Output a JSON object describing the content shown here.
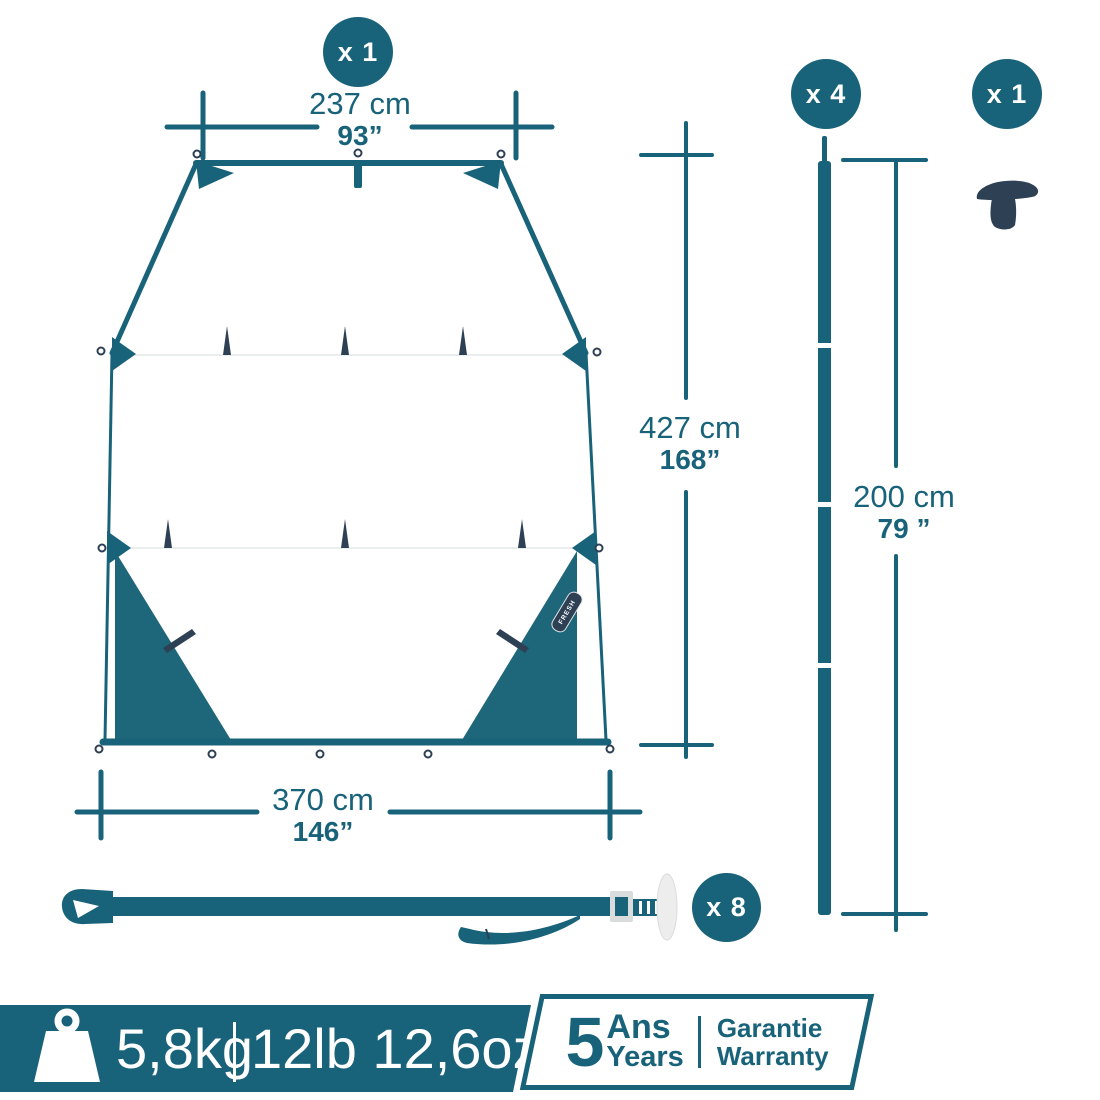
{
  "colors": {
    "teal": "#19637A",
    "teal-fill": "#1E6679",
    "navy": "#2E4054",
    "gray": "#EDEDED"
  },
  "counts": {
    "tarp": "x 1",
    "poles": "x 4",
    "cap": "x 1",
    "straps": "x 8"
  },
  "dimensions": {
    "top_width": {
      "metric": "237 cm",
      "imperial": "93”"
    },
    "length": {
      "metric": "427 cm",
      "imperial": "168”"
    },
    "bottom_width": {
      "metric": "370 cm",
      "imperial": "146”"
    },
    "pole_length": {
      "metric": "200 cm",
      "imperial": "79 ”"
    }
  },
  "tarp": {
    "tag": "FRESH",
    "brand": "QUECHUA",
    "size": "XL"
  },
  "footer": {
    "weight_metric": "5,8kg",
    "weight_imperial": "12lb 12,6oz",
    "warranty_years": "5",
    "warranty_fr": "Ans",
    "warranty_en": "Years",
    "warranty_label_fr": "Garantie",
    "warranty_label_en": "Warranty"
  },
  "icons": {
    "weight": "weight-icon",
    "pole": "pole-icon",
    "pole_cap": "pole-cap-icon",
    "strap": "strap-icon",
    "grommet": "grommet-icon"
  }
}
